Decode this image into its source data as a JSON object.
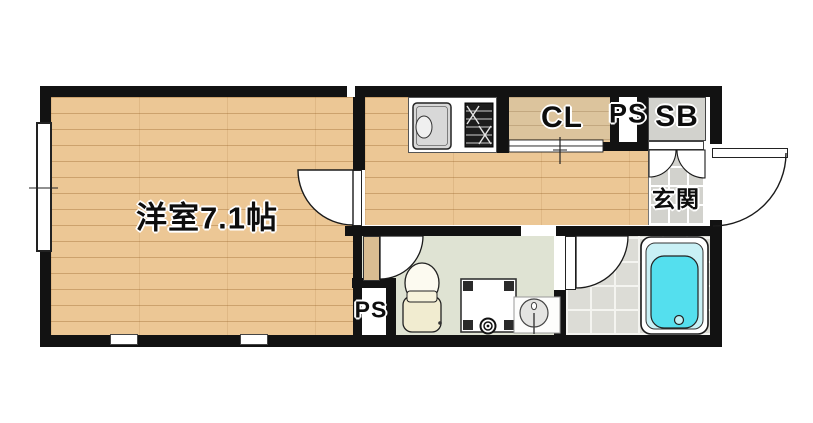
{
  "floorplan": {
    "labels": {
      "main_room": "洋室7.1帖",
      "closet": "CL",
      "pipe_space_upper": "PS",
      "shoe_box": "SB",
      "entrance": "玄関",
      "pipe_space_lower": "PS"
    },
    "colors": {
      "wall": "#121212",
      "wood_floor": "#ecc795",
      "closet_floor": "#dcc49d",
      "washroom_floor": "#dfe3d3",
      "genkan_tile": "#d2d2cd",
      "bathroom_tile": "#dcdcd6",
      "shoe_box_fill": "#d2d2cd",
      "bath_water": "#54dfee",
      "toilet_fill": "#f1ecd0",
      "door_panel_wood": "#d9bd92"
    }
  }
}
